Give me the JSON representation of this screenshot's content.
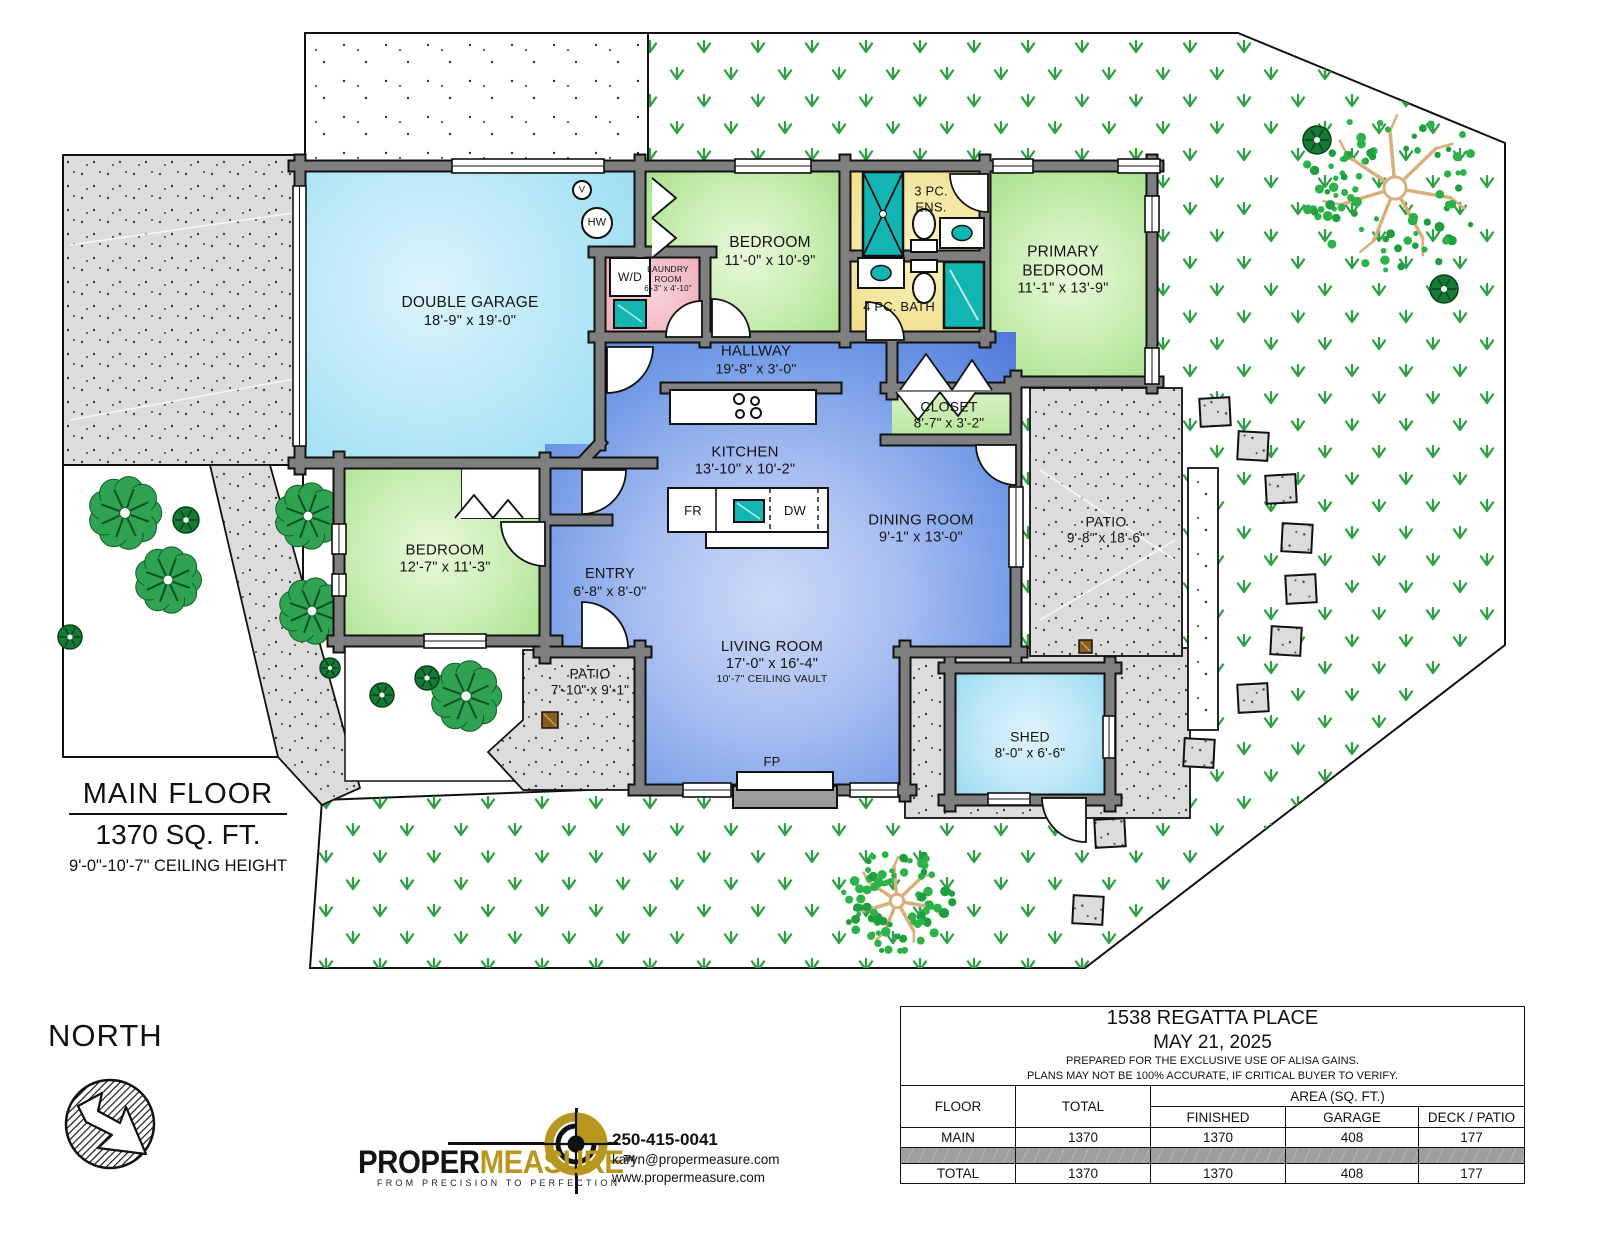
{
  "plan": {
    "floor_title": "MAIN FLOOR",
    "floor_area": "1370 SQ. FT.",
    "ceiling_height": "9'-0\"-10'-7\" CEILING HEIGHT",
    "north_label": "NORTH"
  },
  "rooms": [
    {
      "id": "double-garage",
      "line1": "DOUBLE GARAGE",
      "line2": "18'-9\" x 19'-0\""
    },
    {
      "id": "laundry-room",
      "line1": "LAUNDRY",
      "line2": "ROOM",
      "line3": "6'-3\" x 4'-10\""
    },
    {
      "id": "bedroom-top",
      "line1": "BEDROOM",
      "line2": "11'-0\" x 10'-9\""
    },
    {
      "id": "ensuite",
      "line1": "3 PC.",
      "line2": "ENS."
    },
    {
      "id": "main-bath",
      "line1": "4 PC. BATH"
    },
    {
      "id": "primary-bedroom",
      "line1": "PRIMARY",
      "line2": "BEDROOM",
      "line3": "11'-1\" x 13'-9\""
    },
    {
      "id": "hallway",
      "line1": "HALLWAY",
      "line2": "19'-8\" x 3'-0\""
    },
    {
      "id": "closet",
      "line1": "CLOSET",
      "line2": "8'-7\" x 3'-2\""
    },
    {
      "id": "kitchen",
      "line1": "KITCHEN",
      "line2": "13'-10\" x 10'-2\""
    },
    {
      "id": "dining-room",
      "line1": "DINING ROOM",
      "line2": "9'-1\" x 13'-0\""
    },
    {
      "id": "entry",
      "line1": "ENTRY",
      "line2": "6'-8\" x 8'-0\""
    },
    {
      "id": "bedroom-left",
      "line1": "BEDROOM",
      "line2": "12'-7\" x 11'-3\""
    },
    {
      "id": "living-room",
      "line1": "LIVING ROOM",
      "line2": "17'-0\" x 16'-4\"",
      "line3": "10'-7\" CEILING VAULT"
    },
    {
      "id": "patio-front",
      "line1": "PATIO",
      "line2": "7'-10\" x 9'-1\""
    },
    {
      "id": "patio-back",
      "line1": "PATIO",
      "line2": "9'-8\" x 18'-6\""
    },
    {
      "id": "shed",
      "line1": "SHED",
      "line2": "8'-0\" x 6'-6\""
    }
  ],
  "fixtures": {
    "washer_dryer": "W/D",
    "fridge": "FR",
    "dishwasher": "DW",
    "fireplace": "FP",
    "vent": "V",
    "hot_water": "HW"
  },
  "branding": {
    "name_part1": "PROPER",
    "name_part2": "MEASURE",
    "trademark": "TM",
    "tagline": "FROM PRECISION TO PERFECTION",
    "phone": "250-415-0041",
    "email": "karyn@propermeasure.com",
    "website": "www.propermeasure.com"
  },
  "summary_table": {
    "address": "1538 REGATTA PLACE",
    "date": "MAY 21, 2025",
    "note1": "PREPARED FOR THE EXCLUSIVE USE OF ALISA GAINS.",
    "note2": "PLANS MAY NOT BE 100% ACCURATE, IF CRITICAL BUYER TO VERIFY.",
    "col_floor": "FLOOR",
    "col_total": "TOTAL",
    "col_area": "AREA (SQ. FT.)",
    "col_finished": "FINISHED",
    "col_garage": "GARAGE",
    "col_deck": "DECK / PATIO",
    "rows": [
      {
        "floor": "MAIN",
        "total": "1370",
        "finished": "1370",
        "garage": "408",
        "deck": "177"
      }
    ],
    "total_row": {
      "floor": "TOTAL",
      "total": "1370",
      "finished": "1370",
      "garage": "408",
      "deck": "177"
    }
  },
  "colors": {
    "wall": "#7f7f7f",
    "open_blue": "#5079da",
    "bedroom_green": "#a9e18e",
    "bath_yellow": "#efdc82",
    "laundry_pink": "#eda9b6",
    "fixture_teal": "#12b5b1",
    "garage_blue": "#9adef4",
    "grass": "#2f9e44",
    "brand_gold": "#b8971e",
    "concrete": "#dcdcdc"
  }
}
